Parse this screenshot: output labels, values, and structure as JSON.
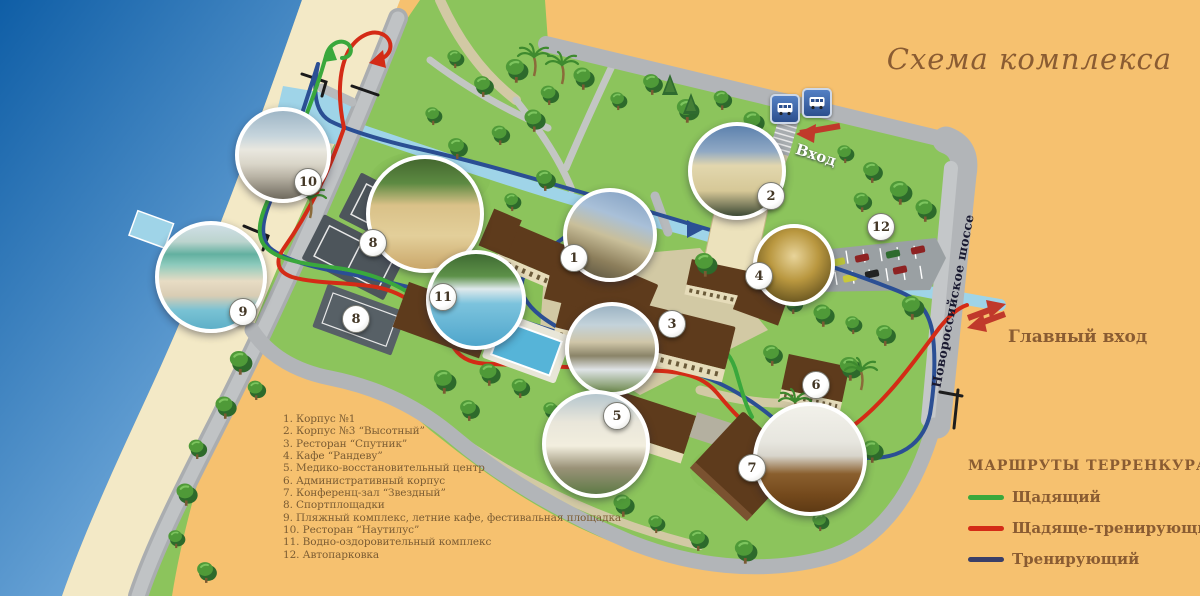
{
  "title": "Схема комплекса",
  "labels": {
    "entrance_top": "Вход",
    "entrance_main": "Главный вход",
    "highway": "Новороссийское шоссе"
  },
  "legend": {
    "items": [
      "1. Корпус №1",
      "2. Корпус №3 “Высотный”",
      "3. Ресторан “Спутник”",
      "4. Кафе “Рандеву”",
      "5. Медико-восстановительный центр",
      "6. Административный корпус",
      "7. Конференц-зал “Звездный”",
      "8. Спортплощадки",
      "9. Пляжный комплекс, летние кафе, фестивальная площадка",
      "10. Ресторан “Наутилус”",
      "11. Водно-оздоровительный комплекс",
      "12. Автопарковка"
    ]
  },
  "routes_legend": {
    "title": "МАРШРУТЫ ТЕРРЕНКУРА",
    "items": [
      {
        "label": "Щадящий",
        "color": "#3aa83c"
      },
      {
        "label": "Щадяще-тренирующий",
        "color": "#d42b16"
      },
      {
        "label": "Тренирующий",
        "color": "#3a3f68"
      }
    ]
  },
  "markers": {
    "m1": "1",
    "m2": "2",
    "m3": "3",
    "m4": "4",
    "m5": "5",
    "m6": "6",
    "m7": "7",
    "m8": "8",
    "m8b": "8",
    "m9": "9",
    "m10": "10",
    "m11": "11",
    "m12": "12"
  },
  "colors": {
    "background": "#f6c16f",
    "sea_deep": "#0f5ea6",
    "sea_light": "#81b6e3",
    "beach": "#f3e9c6",
    "grass": "#8cc45c",
    "road": "#b7babc",
    "river": "#9fd4e8",
    "route_green": "#3aa83c",
    "route_red": "#d42b16",
    "route_blue": "#2b4f94",
    "accent_brown": "#8a5c32",
    "roof_brown": "#5e3b1c"
  }
}
